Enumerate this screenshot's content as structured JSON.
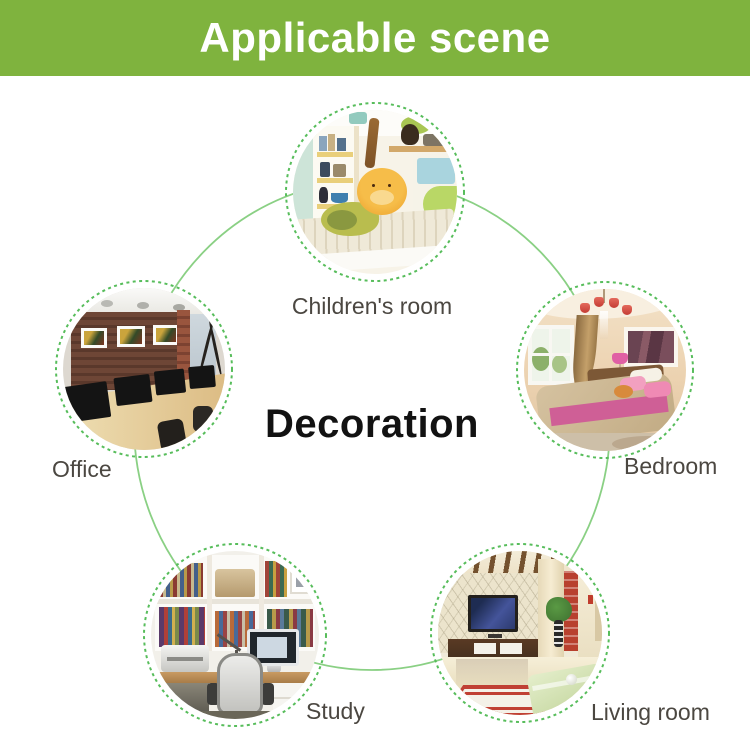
{
  "banner": {
    "title": "Applicable scene"
  },
  "center": {
    "label": "Decoration"
  },
  "nodes": {
    "children": {
      "label": "Children's room",
      "alt": "Children's room with white shelves, plush toys and a striped bed with an orange bear pillow"
    },
    "bedroom": {
      "label": "Bedroom",
      "alt": "Bedroom with chandelier, window, brown curtain, framed picture and bed with pink pillows"
    },
    "living": {
      "label": "Living room",
      "alt": "Living room with wall TV, wood cabinet, plant, red accent wall and glass table"
    },
    "study": {
      "label": "Study",
      "alt": "Study with white bookshelves full of books, desk computer, printer and office chair"
    },
    "office": {
      "label": "Office",
      "alt": "Office with dark wood wall, three framed pictures and monitors on a long wooden desk"
    }
  },
  "colors": {
    "banner-green": "#7fb33e",
    "link-green": "#8ad084",
    "ring-green": "#57bd5b",
    "label-color": "#4b4741",
    "center-color": "#121212"
  }
}
